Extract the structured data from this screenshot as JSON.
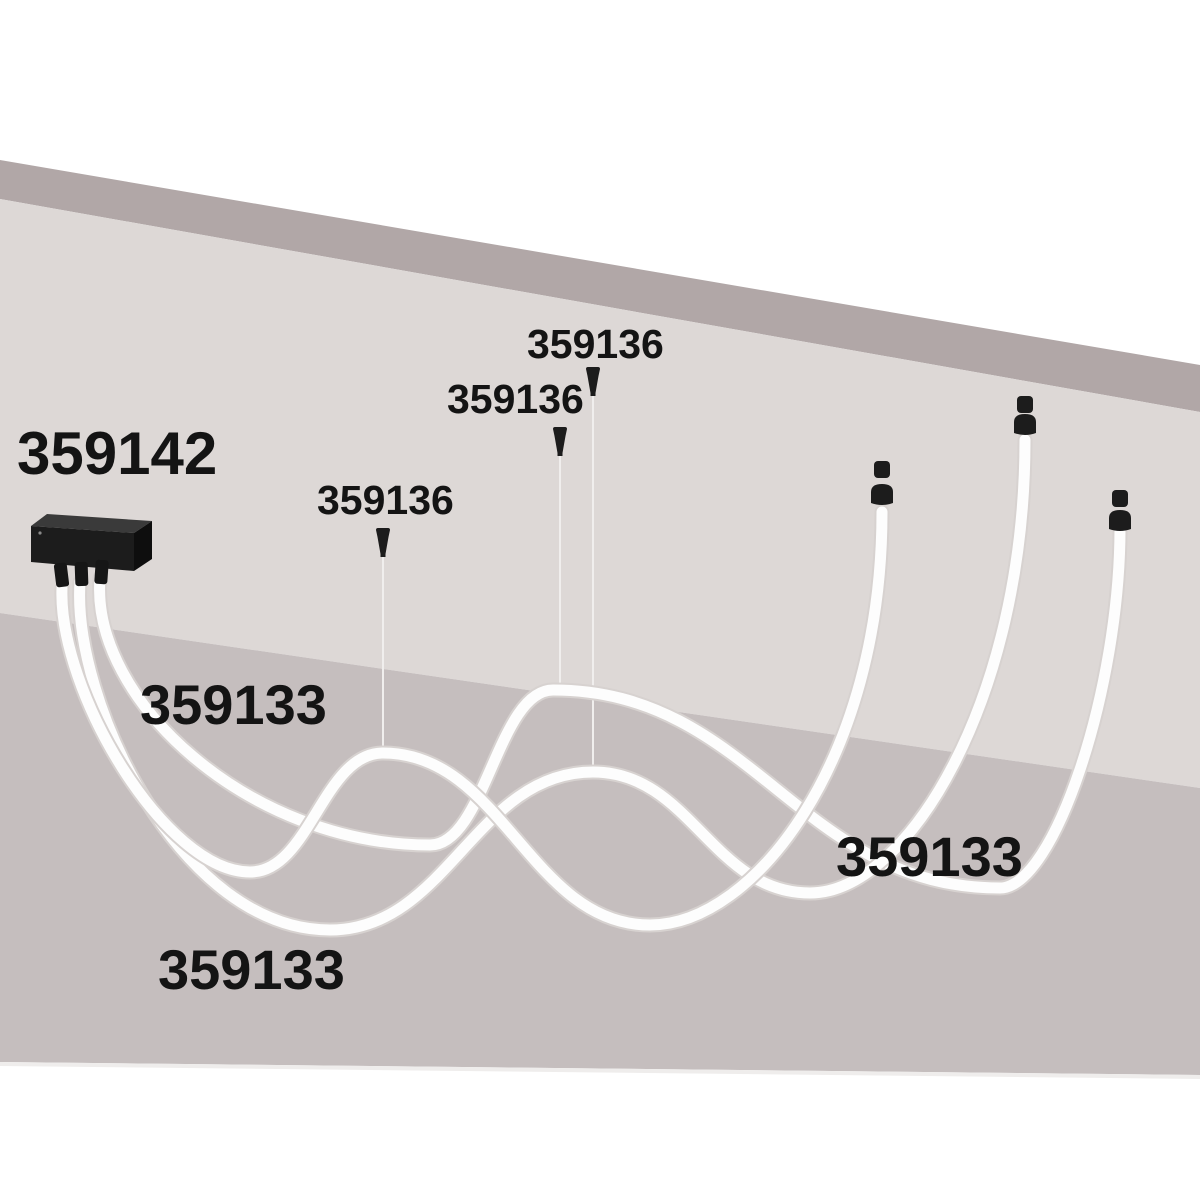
{
  "diagram_type": "product-installation-diagram",
  "product": "flexible LED tube pendant system",
  "labels": {
    "driver_box": "359142",
    "suspension_kit_1": "359136",
    "suspension_kit_2": "359136",
    "suspension_kit_3": "359136",
    "flex_tube_left": "359133",
    "flex_tube_right": "359133",
    "flex_tube_bottom": "359133"
  },
  "colors": {
    "background": "#ffffff",
    "ceiling_band": "#b1a7a7",
    "wall_upper": "#ddd8d6",
    "wall_lower": "#c5bebe",
    "hardware_black": "#1c1c1c",
    "hardware_black_top": "#3a3a3a",
    "tube_white": "#fdfdfd",
    "tube_edge": "#d7d2d0",
    "suspension_wire": "#f0eeed",
    "label_text": "#141414"
  },
  "icon_semantics": {
    "driver-box-icon": "black rectangular power driver with three tube sockets",
    "suspension-mount-icon": "small black ceiling cone mount with thin wire",
    "tube-end-cap-icon": "black dome end cap with floating mount knob above"
  }
}
